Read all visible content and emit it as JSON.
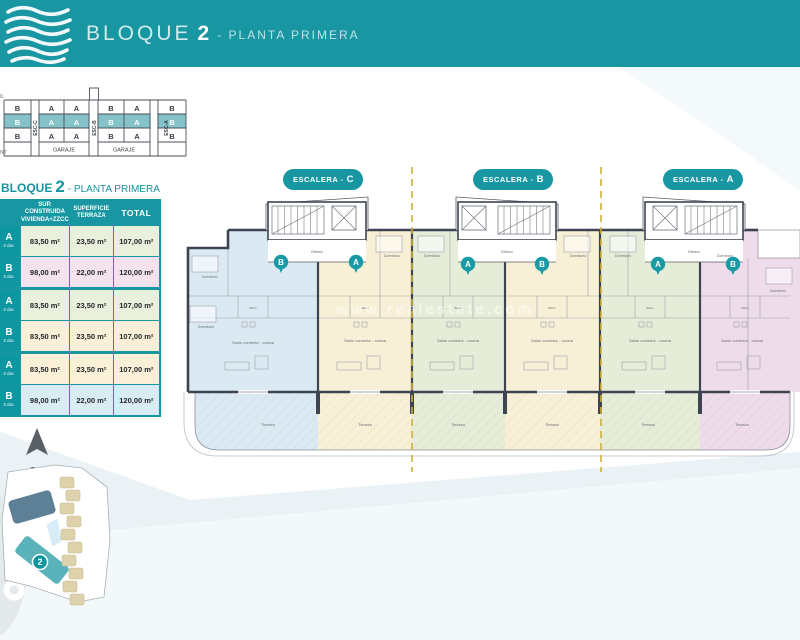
{
  "colors": {
    "teal": "#1897a2",
    "badge_teal": "#0f97a1",
    "dashed_line": "#d2ae3a",
    "wall": "#3e4451",
    "apartment_blue": "#dbe9f3",
    "apartment_cream": "#f8f0d6",
    "apartment_green": "#e5edd8",
    "apartment_pink": "#efdcea",
    "row_green": "#e9f0dc",
    "row_pink": "#f4e3ed",
    "row_cream": "#faf0d7",
    "row_blue": "#d9ecf4"
  },
  "header": {
    "brand": "BLOQUE",
    "number": "2",
    "subtitle": "- PLANTA PRIMERA"
  },
  "profile": {
    "fragment_top": "IL",
    "fragment_bottom": "NT",
    "units_row": [
      "B",
      "A",
      "A",
      "B",
      "A",
      "B"
    ],
    "esc": [
      "ESC-C",
      "ESC-B",
      "ESC-A"
    ],
    "garaje": "GARAJE"
  },
  "table": {
    "title_brand": "BLOQUE",
    "title_number": "2",
    "title_sub": "- PLANTA PRIMERA",
    "col_built_1": "SUP. CONSTRUIDA",
    "col_built_2": "VIVIENDA+ZZCC",
    "col_terr_1": "SUPERFICIE",
    "col_terr_2": "TERRAZA",
    "col_total": "TOTAL",
    "rows": [
      {
        "unit": "A",
        "dorm": "2 dor.",
        "built": "83,50 m²",
        "terrace": "23,50 m²",
        "total": "107,00 m²"
      },
      {
        "unit": "B",
        "dorm": "3 dor.",
        "built": "98,00 m²",
        "terrace": "22,00 m²",
        "total": "120,00 m²"
      },
      {
        "unit": "A",
        "dorm": "2 dor.",
        "built": "83,50 m²",
        "terrace": "23,50 m²",
        "total": "107,00 m²"
      },
      {
        "unit": "B",
        "dorm": "2 dor.",
        "built": "83,50 m²",
        "terrace": "23,50 m²",
        "total": "107,00 m²"
      },
      {
        "unit": "A",
        "dorm": "2 dor.",
        "built": "83,50 m²",
        "terrace": "23,50 m²",
        "total": "107,00 m²"
      },
      {
        "unit": "B",
        "dorm": "3 dor.",
        "built": "98,00 m²",
        "terrace": "22,00 m²",
        "total": "120,00 m²"
      }
    ]
  },
  "escaleras": [
    {
      "prefix": "ESCALERA -",
      "letter": "C"
    },
    {
      "prefix": "ESCALERA -",
      "letter": "B"
    },
    {
      "prefix": "ESCALERA -",
      "letter": "A"
    }
  ],
  "plan": {
    "badges": [
      "B",
      "A",
      "A",
      "B",
      "A",
      "B"
    ],
    "labels": {
      "rellano": "Rellano",
      "salon": "Salón comedor - cocina",
      "dormitorio": "Dormitorio",
      "bano": "Baño",
      "terraza": "Terraza"
    },
    "watermark": "www.realestate.com"
  },
  "siteplan": {
    "north": "N",
    "badge": "2"
  }
}
